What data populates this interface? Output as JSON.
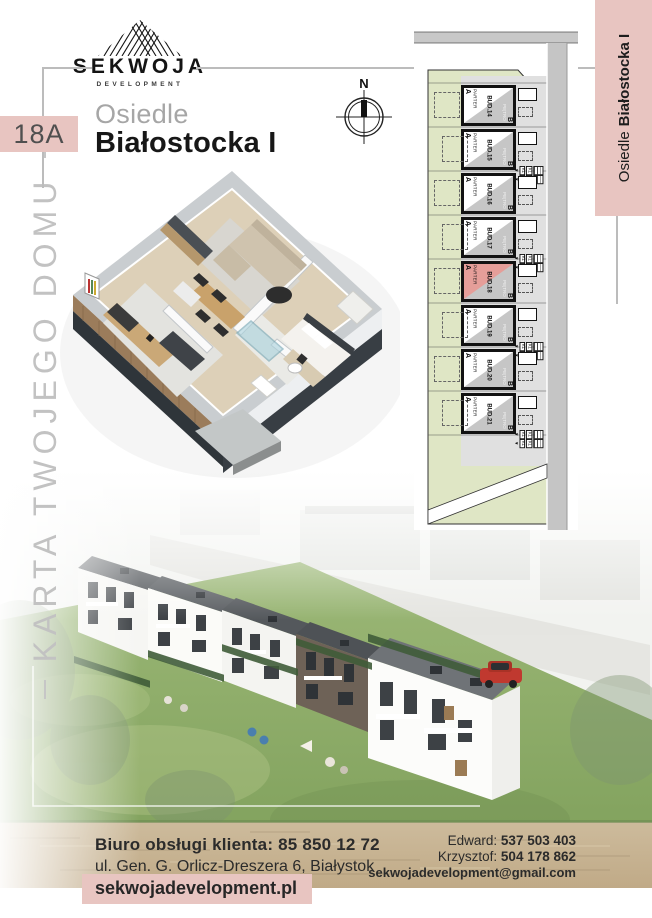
{
  "brand": {
    "name": "SEKWOJA",
    "tagline": "DEVELOPMENT"
  },
  "header": {
    "unit_badge": "18A",
    "estate_prefix": "Osiedle",
    "estate_name": "Białostocka I"
  },
  "left_rail": {
    "vertical_text": "KARTA TWOJEGO DOMU"
  },
  "right_rail": {
    "banner_prefix": "Osiedle",
    "banner_name": "Białostocka I"
  },
  "compass": {
    "north": "N"
  },
  "siteplan": {
    "floor_label": "PARTER",
    "upper_floor_label": "PIĘTRO",
    "unit_a": "A",
    "unit_b": "B",
    "stair_label": "KL",
    "buildings": [
      {
        "id": "BUD.14",
        "highlighted": false
      },
      {
        "id": "BUD.15",
        "highlighted": false
      },
      {
        "id": "BUD.16",
        "highlighted": false
      },
      {
        "id": "BUD.17",
        "highlighted": false
      },
      {
        "id": "BUD.18",
        "highlighted": true
      },
      {
        "id": "BUD.19",
        "highlighted": false
      },
      {
        "id": "BUD.20",
        "highlighted": false
      },
      {
        "id": "BUD.21",
        "highlighted": false
      }
    ]
  },
  "footer": {
    "office_line": "Biuro obsługi klienta: 85 850 12 72",
    "address": "ul. Gen. G. Orlicz-Dreszera 6, Białystok",
    "website": "sekwojadevelopment.pl",
    "contacts": [
      {
        "name": "Edward:",
        "phone": "537 503 403"
      },
      {
        "name": "Krzysztof:",
        "phone": "504 178 862"
      }
    ],
    "email": "sekwojadevelopment@gmail.com"
  },
  "colors": {
    "accent": "#e8c5c1",
    "highlight": "#e59e99",
    "plan_green": "#dfe6c5",
    "plan_road": "#c8c8c8"
  }
}
